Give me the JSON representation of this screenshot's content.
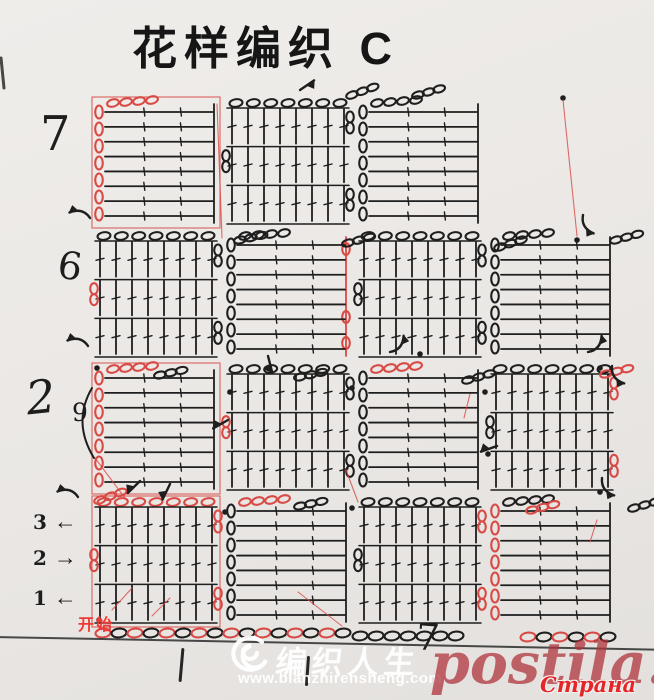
{
  "title": "花样编织 C",
  "colors": {
    "paper": "#eae7e4",
    "ink": "#1e1e1e",
    "red_trace": "#d84a45",
    "start_red": "#ee3a35",
    "postila_red": "#af333b",
    "strana_red": "#e4262b",
    "watermark_white": "#ffffff"
  },
  "row_labels": [
    {
      "text": "7"
    },
    {
      "text": "6"
    },
    {
      "text": "2"
    }
  ],
  "chain_count_label": {
    "text": "9"
  },
  "bottom_row_labels": [
    {
      "text": "3",
      "arrow": "←"
    },
    {
      "text": "2",
      "arrow": "→"
    },
    {
      "text": "1",
      "arrow": "←"
    }
  ],
  "start_label": "开始",
  "pen_mark_label": "7",
  "watermarks": {
    "logo_text": "编织人生",
    "logo_url": "www.bianzhirensheng.com",
    "postila": "postila.ru",
    "strana": "Страна Мам"
  },
  "diagram": {
    "grid": {
      "x0": 95,
      "y0": 100,
      "col_w": 132,
      "row_h": 133,
      "block_w": 122,
      "block_h": 124
    },
    "blocks": [
      {
        "row": 0,
        "col": 0,
        "type": "h",
        "red": "full"
      },
      {
        "row": 0,
        "col": 1,
        "type": "v",
        "red": null
      },
      {
        "row": 0,
        "col": 2,
        "type": "h",
        "red": null
      },
      {
        "row": 1,
        "col": 0,
        "type": "v",
        "red": "left"
      },
      {
        "row": 1,
        "col": 1,
        "type": "h",
        "red": "right"
      },
      {
        "row": 1,
        "col": 2,
        "type": "v",
        "red": null
      },
      {
        "row": 1,
        "col": 3,
        "type": "h",
        "red": null
      },
      {
        "row": 2,
        "col": 0,
        "type": "h",
        "red": "full"
      },
      {
        "row": 2,
        "col": 1,
        "type": "v",
        "red": "left"
      },
      {
        "row": 2,
        "col": 2,
        "type": "h",
        "red": "top"
      },
      {
        "row": 2,
        "col": 3,
        "type": "v",
        "red": "right"
      },
      {
        "row": 3,
        "col": 0,
        "type": "v",
        "red": "full"
      },
      {
        "row": 3,
        "col": 1,
        "type": "h",
        "red": "top"
      },
      {
        "row": 3,
        "col": 2,
        "type": "v",
        "red": "right"
      },
      {
        "row": 3,
        "col": 3,
        "type": "h",
        "red": "left"
      }
    ],
    "foundation_chains": [
      {
        "x": 95,
        "y": 633,
        "count": 16,
        "red": true
      },
      {
        "x": 352,
        "y": 636,
        "count": 7,
        "red": false
      },
      {
        "x": 520,
        "y": 637,
        "count": 6,
        "red": true
      }
    ],
    "connector_chains": [
      {
        "x": 352,
        "y": 95,
        "rot": -20,
        "red": false
      },
      {
        "x": 418,
        "y": 95,
        "rot": -16,
        "red": false
      },
      {
        "x": 240,
        "y": 240,
        "rot": -12,
        "red": false
      },
      {
        "x": 348,
        "y": 243,
        "rot": -15,
        "red": false
      },
      {
        "x": 500,
        "y": 247,
        "rot": -18,
        "red": false
      },
      {
        "x": 616,
        "y": 240,
        "rot": -15,
        "red": false
      },
      {
        "x": 160,
        "y": 375,
        "rot": -12,
        "red": false
      },
      {
        "x": 300,
        "y": 377,
        "rot": -12,
        "red": false
      },
      {
        "x": 468,
        "y": 380,
        "rot": -16,
        "red": false
      },
      {
        "x": 606,
        "y": 374,
        "rot": -14,
        "red": true
      },
      {
        "x": 100,
        "y": 500,
        "rot": -20,
        "red": true
      },
      {
        "x": 300,
        "y": 506,
        "rot": -12,
        "red": false
      },
      {
        "x": 532,
        "y": 510,
        "rot": -14,
        "red": true
      },
      {
        "x": 634,
        "y": 508,
        "rot": -16,
        "red": false
      }
    ],
    "arrows": [
      {
        "x": 300,
        "y": 90,
        "rot": -55,
        "kind": "s"
      },
      {
        "x": 583,
        "y": 215,
        "rot": 15,
        "kind": "c"
      },
      {
        "x": 90,
        "y": 218,
        "rot": 150,
        "kind": "c"
      },
      {
        "x": 588,
        "y": 352,
        "rot": -95,
        "kind": "c"
      },
      {
        "x": 612,
        "y": 366,
        "rot": 10,
        "kind": "c"
      },
      {
        "x": 88,
        "y": 346,
        "rot": 150,
        "kind": "c"
      },
      {
        "x": 268,
        "y": 356,
        "rot": 55,
        "kind": "s"
      },
      {
        "x": 390,
        "y": 352,
        "rot": -95,
        "kind": "c"
      },
      {
        "x": 497,
        "y": 446,
        "rot": 140,
        "kind": "s"
      },
      {
        "x": 602,
        "y": 478,
        "rot": 10,
        "kind": "c"
      },
      {
        "x": 78,
        "y": 497,
        "rot": 150,
        "kind": "c"
      },
      {
        "x": 140,
        "y": 481,
        "rot": 115,
        "kind": "s"
      },
      {
        "x": 170,
        "y": 484,
        "rot": 95,
        "kind": "s"
      },
      {
        "x": 228,
        "y": 420,
        "rot": 130,
        "kind": "s"
      }
    ],
    "dots": [
      [
        577,
        240
      ],
      [
        600,
        368
      ],
      [
        485,
        392
      ],
      [
        600,
        492
      ],
      [
        352,
        508
      ],
      [
        97,
        368
      ],
      [
        225,
        512
      ],
      [
        420,
        354
      ],
      [
        488,
        454
      ],
      [
        230,
        392
      ],
      [
        352,
        388
      ],
      [
        563,
        98
      ],
      [
        99,
        620
      ]
    ],
    "red_lines": [
      [
        563,
        100,
        577,
        236
      ],
      [
        346,
        470,
        358,
        502
      ],
      [
        470,
        394,
        464,
        418
      ],
      [
        95,
        458,
        128,
        502
      ],
      [
        298,
        592,
        342,
        626
      ],
      [
        597,
        520,
        590,
        542
      ],
      [
        112,
        610,
        132,
        588
      ],
      [
        152,
        616,
        170,
        598
      ],
      [
        217,
        104,
        222,
        238
      ]
    ],
    "ink_lines": [
      [
        1,
        58,
        4,
        88
      ]
    ],
    "brace9": {
      "x1": 92,
      "y1": 388,
      "cx": 72,
      "cy": 422,
      "x2": 94,
      "y2": 458
    }
  }
}
